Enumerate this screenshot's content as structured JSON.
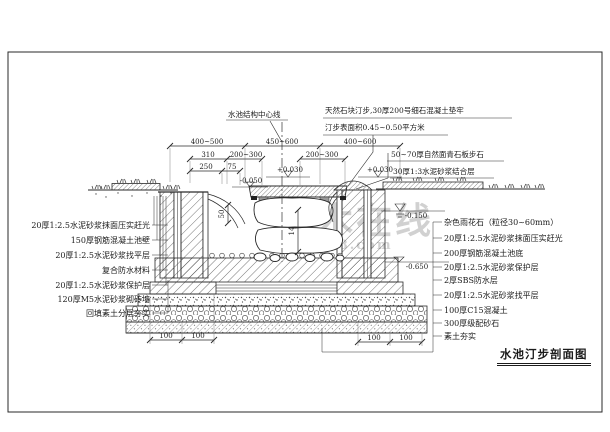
{
  "drawing": {
    "title": "水池汀步剖面图",
    "watermark": {
      "text": "土木在线",
      "subtext": "co188.com"
    },
    "notes": {
      "centerline": "水池结构中心线",
      "stepping_line1": "天然石块汀步,30厚200号细石混凝土垫牢",
      "stepping_line2": "汀步表面积0.45~0.50平方米",
      "slab_line1": "50~70厚自然面青石板步石",
      "slab_line2": "30厚1:3水泥砂浆结合层"
    },
    "left_labels": [
      "20厚1:2.5水泥砂浆抹面压实赶光",
      "150厚钢筋混凝土池壁",
      "20厚1:2.5水泥砂浆找平层",
      "复合防水材料",
      "20厚1:2.5水泥砂浆保护层",
      "120厚M5水泥砂浆砌砖墙",
      "回填素土分层夯实"
    ],
    "right_labels": [
      "杂色雨花石（粒径30~60mm）",
      "20厚1:2.5水泥砂浆抹面压实赶光",
      "200厚钢筋混凝土池底",
      "20厚1:2.5水泥砂浆保护层",
      "2厚SBS防水层",
      "20厚1:2.5水泥砂浆找平层",
      "100厚C15混凝土",
      "300厚级配砂石",
      "素土夯实"
    ],
    "dimensions": {
      "top": [
        "400~500",
        "450~600",
        "400~600"
      ],
      "mid": [
        "310",
        "200~300",
        "200~300"
      ],
      "low": [
        "250",
        "75"
      ],
      "vert": [
        "50",
        "14"
      ],
      "bottom_left": [
        "100",
        "100"
      ],
      "bottom_right": [
        "100",
        "100"
      ]
    },
    "elevations": {
      "step_top": "+0.030",
      "step_top_right": "+0.030",
      "pool_edge": "-0.050",
      "water": "-0.150",
      "bottom": "-0.650"
    }
  },
  "colors": {
    "line": "#2a2a2a",
    "watermark": "#b2b2b2",
    "background": "#ffffff"
  }
}
